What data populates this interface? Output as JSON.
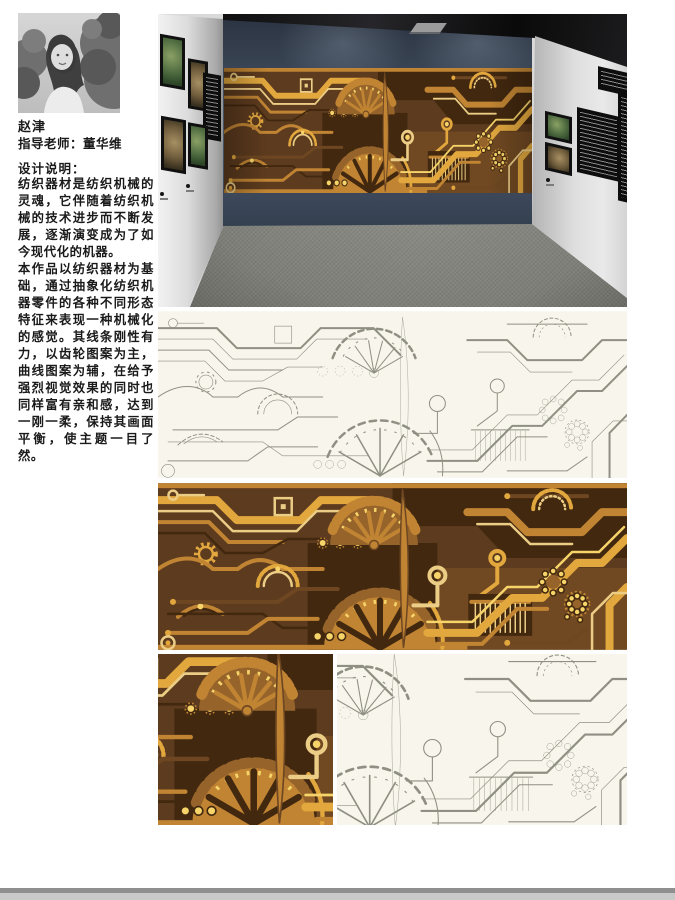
{
  "student": {
    "name": "赵津",
    "advisor": "指导老师：董华维"
  },
  "design_note": {
    "title": "设计说明：",
    "paragraph1": "纺织器材是纺织机械的灵魂，它伴随着纺织机械的技术进步而不断发展，逐渐演变成为了如今现代化的机器。",
    "paragraph2": "本作品以纺织器材为基础，通过抽象化纺织机器零件的各种不同形态特征来表现一种机械化的感觉。其线条刚性有力，以齿轮图案为主，曲线图案为辅，在给予强烈视觉效果的同时也同样富有亲和感，达到一刚一柔，保持其画面平衡，使主题一目了然。"
  },
  "theme": {
    "mural_bg": "#5D3B1E",
    "mural_gold": "#E2A83E",
    "mural_bright": "#F6D469",
    "mural_tan": "#C08433",
    "mural_pale": "#EBCD86",
    "mural_dark": "#42280F",
    "lineart_bg": "#F8F6EC",
    "lineart_stroke": "#8F8F83",
    "wall_blue": "#3C4656",
    "ceiling_black": "#121212",
    "side_wall_gray": "#DFDFDF",
    "floor_gray": "#8C8D85",
    "footer_bar_gray": "#8F8F8F"
  }
}
